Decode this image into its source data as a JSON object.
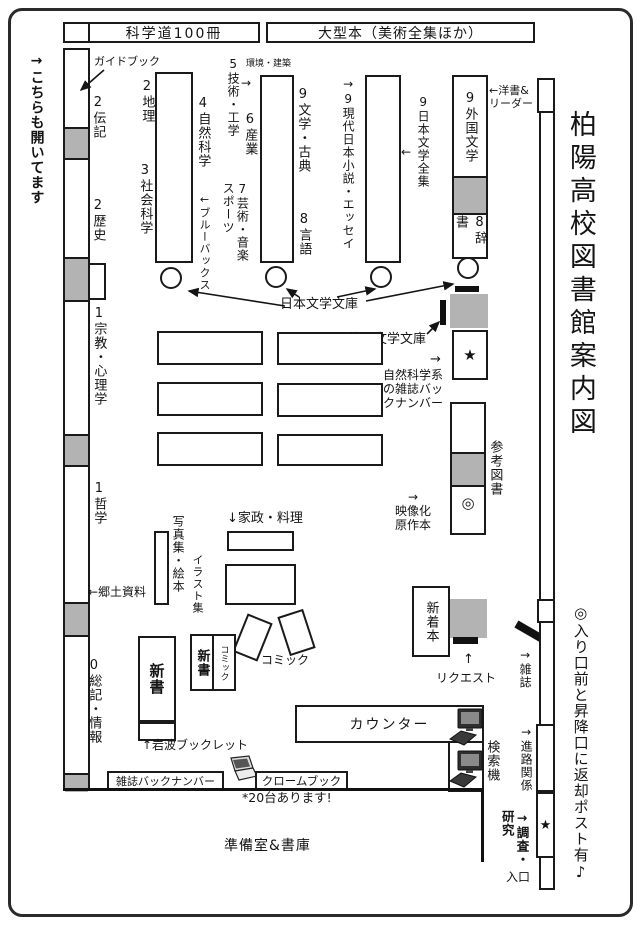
{
  "title": "柏陽高校図書館案内図",
  "notes": {
    "return_post": "◎入り口前と昇降口に返却ポスト有♪",
    "also_open": "→こちらも開いてます",
    "chromebook_count": "*20台あります!"
  },
  "top_row": {
    "science100": "科学道100冊",
    "large_books": "大型本（美術全集ほか）"
  },
  "left_wall": {
    "guidebook": "ガイドブック",
    "biography": "2伝記",
    "history": "2歴史",
    "religion_psychology": "1宗教・心理学",
    "philosophy": "1哲学",
    "local_materials": "←郷土資料",
    "general_works": "0総記・情報"
  },
  "shelves": {
    "geography": "2地理",
    "social_science": "3社会科学",
    "natural_science": "4自然科学",
    "blue_backs": "←ブルーバックス",
    "technology": "5技術・工学",
    "technology_note": "環境・建築",
    "industry": "6産業",
    "arts_music_sports": "7芸術・音楽\nスポーツ",
    "literature_classics": "9文学・古典",
    "language": "8言語",
    "modern_jp_novels": "→9現代日本小説・エッセイ",
    "jp_literature_complete": "9日本文学全集",
    "foreign_literature": "9外国文学",
    "dictionaries": "8辞書",
    "western_books": "←洋書&\nリーダー"
  },
  "center": {
    "jp_bunko": "日本文学文庫",
    "foreign_bunko": "外国文学文庫",
    "science_magazine_backnumbers": "自然科学系\nの雑誌バッ\nクナンバー",
    "reference_books": "参考図書",
    "film_adaptations": "→\n映像化\n原作本",
    "home_economics": "↓家政・料理",
    "photo_books": "写真集・絵本",
    "illustrations": "イラスト集",
    "comics": "コミック",
    "shinsho": "新書",
    "shinsho2": "新書",
    "comic_col": "コミック",
    "iwanami": "↑岩波ブックレット",
    "new_arrivals": "新着本",
    "request": "リクエスト",
    "magazines": "→雑誌"
  },
  "bottom": {
    "counter": "カウンター",
    "search_machines": "検索機",
    "magazine_backnumber": "雑誌バックナンバー",
    "chromebook": "クロームブック",
    "prep_room": "準備室&書庫",
    "career": "→進路関係",
    "research": "→調査・\n研究",
    "entrance": "入口"
  },
  "glyphs": {
    "right_arrow": "→",
    "left_arrow": "←",
    "up_arrow": "↑",
    "star": "★",
    "double_circle": "◎"
  },
  "colors": {
    "ink": "#1a1a1a",
    "gray_fill": "#b3b3b3"
  }
}
